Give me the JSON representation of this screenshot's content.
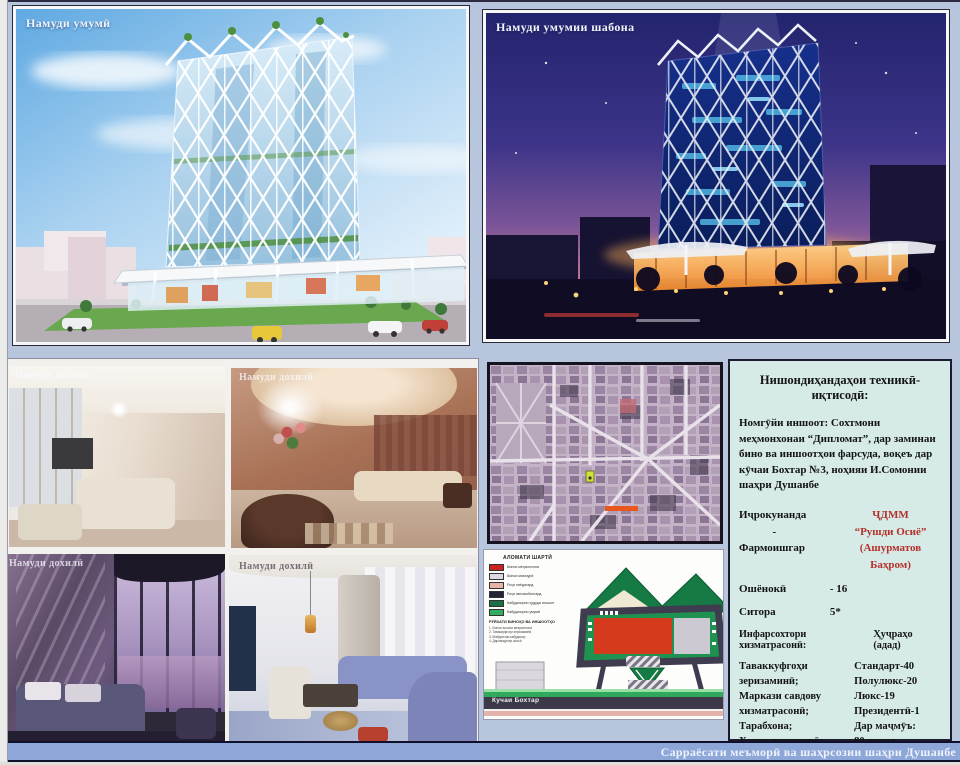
{
  "colors": {
    "board_bg": "#b7c5dd",
    "bottom_bar_bg": "#8da7d8",
    "info_panel_bg": "#d6ebe7",
    "accent_red_text": "#b5302a",
    "site_marker_orange": "#e8571e",
    "plan_footprint_red": "#d63a1c"
  },
  "panels": {
    "day_render": {
      "label": "Намуди умумӣ"
    },
    "night_render": {
      "label": "Намуди умумии шабона"
    },
    "interiors": {
      "labels": [
        "Намуди дохилӣ",
        "Намуди дохилӣ",
        "Намуди дохилӣ",
        "Намуди дохилӣ"
      ]
    },
    "site": {
      "legend": {
        "title": "АЛОМАТИ ШАРТӢ",
        "items": [
          {
            "color": "#c8231d",
            "label": "Бинои меҳмонхона"
          },
          {
            "color": "#dcd8e4",
            "label": "Бинои маъмурӣ"
          },
          {
            "color": "#e9b3aa",
            "label": "Роҳи пиёдагард"
          },
          {
            "color": "#23233a",
            "label": "Роҳи автомобилгард"
          },
          {
            "color": "#1c6f47",
            "label": "Кабудизории ҳудуди иншоот"
          },
          {
            "color": "#2fae62",
            "label": "Кабудизории умумӣ"
          }
        ],
        "list_title": "РӮЙХАТИ БИНОҲО ВА ИНШООТҲО",
        "list_items": [
          "1. Бинои асосии меҳмонхона",
          "2. Таваккуфгоҳи зеризаминӣ",
          "3. Майдончаи кабудизор",
          "4. Даромадгоҳи асосӣ"
        ]
      },
      "street_label": "Кучаи Бохтар"
    },
    "info": {
      "title": "Нишондиҳандаҳои техникӣ-иқтисодӣ:",
      "object_paragraph": "Номгӯйи иншоот: Сохтмони меҳмонхонаи “Дипломат”, дар заминаи бино ва иншоотҳои фарсуда, воқеъ дар кӯчаи Бохтар №3, ноҳияи И.Сомонии шаҳри Душанбе",
      "executor_label": "Иҷрокунанда",
      "dash": "-",
      "client_label": "Фармоишгар",
      "executor_value_line1": "ҶДММ",
      "executor_value_line2": "“Рушди Осиё”",
      "client_value": "(Ашурматов Баҳром)",
      "floors_label": "Ошёнокӣ",
      "floors_value": "- 16",
      "stars_label": "Ситора",
      "stars_value": "5*",
      "infra_label": "Инфарсохтори хизматрасонӣ:",
      "rooms_label": "Ҳуҷраҳо (адад)",
      "infra_lines": [
        "Таваккуфгоҳи зеризаминӣ;",
        "Маркази савдову",
        "хизматрасонӣ;",
        "Тарабхона;",
        "Ҳавзи шиноварӣ;",
        "Маҷлисгоҳ."
      ],
      "room_lines": [
        "Стандарт-40",
        "Полулюкс-20",
        "Люкс-19",
        "Президентӣ-1",
        "Дар маҷмӯъ:",
        "80 ҳуҷра"
      ]
    }
  },
  "bottom_bar": {
    "label": "Сарраёсати меъморӣ ва шаҳрсозии шаҳри Душанбе"
  }
}
